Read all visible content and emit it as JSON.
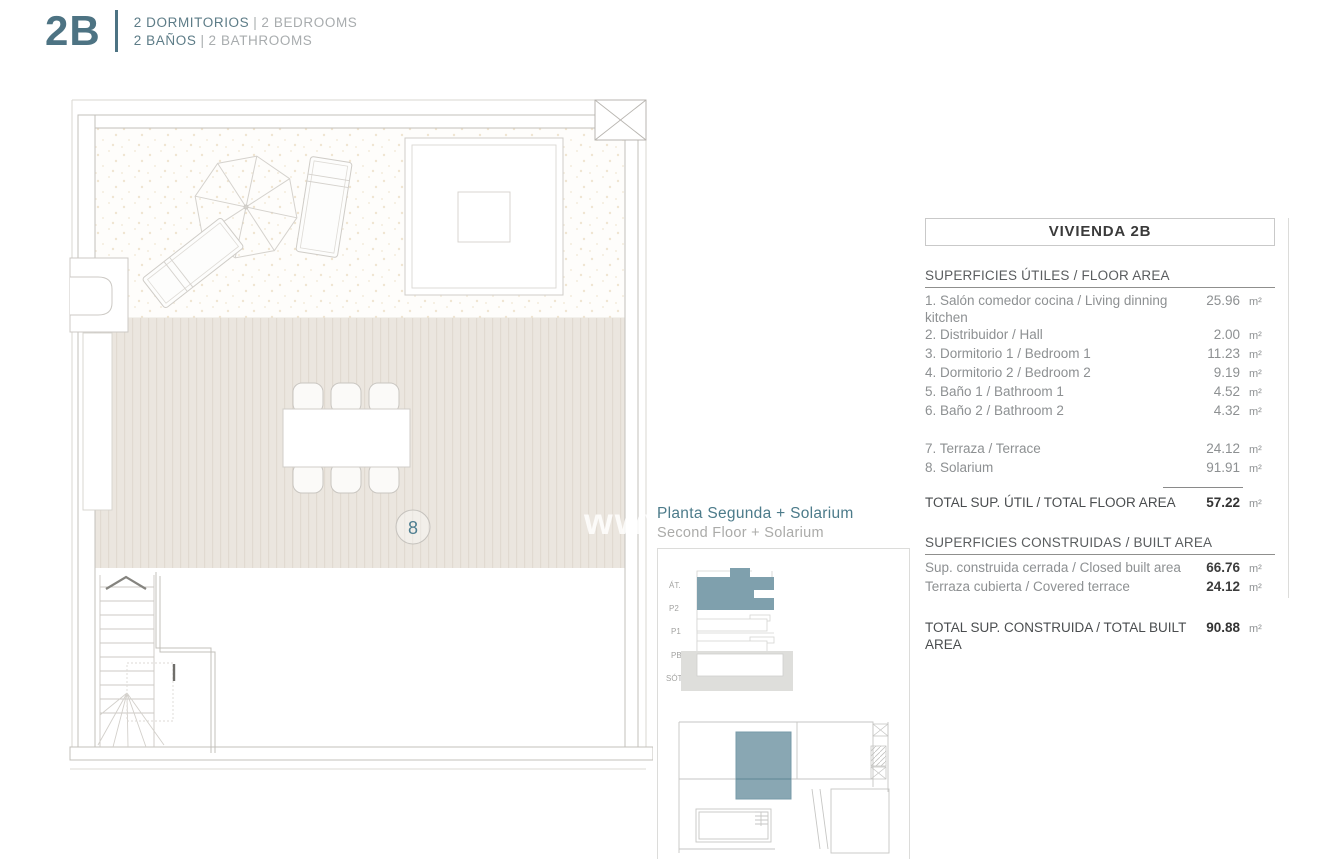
{
  "header": {
    "logo": "2B",
    "rooms_es": "2 DORMITORIOS",
    "rooms_en": "2 BEDROOMS",
    "baths_es": "2 BAÑOS",
    "baths_en": "2 BATHROOMS",
    "sep": "|"
  },
  "plan": {
    "room_label": "8",
    "watermark": "www.imm"
  },
  "location": {
    "title_es": "Planta Segunda + Solarium",
    "title_en": "Second Floor + Solarium",
    "floors": [
      "ÁT.",
      "P2",
      "P1",
      "PB",
      "SÓT."
    ]
  },
  "table": {
    "title": "VIVIENDA 2B",
    "floor_header": "SUPERFICIES ÚTILES / FLOOR AREA",
    "floor_rows": [
      {
        "label": "1. Salón comedor cocina / Living dinning kitchen",
        "value": "25.96",
        "unit": "m²"
      },
      {
        "label": "2. Distribuidor / Hall",
        "value": "2.00",
        "unit": "m²"
      },
      {
        "label": "3. Dormitorio 1 / Bedroom 1",
        "value": "11.23",
        "unit": "m²"
      },
      {
        "label": "4. Dormitorio 2 / Bedroom 2",
        "value": "9.19",
        "unit": "m²"
      },
      {
        "label": "5. Baño 1 / Bathroom 1",
        "value": "4.52",
        "unit": "m²"
      },
      {
        "label": "6. Baño 2 / Bathroom 2",
        "value": "4.32",
        "unit": "m²"
      }
    ],
    "terrace_rows": [
      {
        "label": "7. Terraza / Terrace",
        "value": "24.12",
        "unit": "m²"
      },
      {
        "label": "8. Solarium",
        "value": "91.91",
        "unit": "m²"
      }
    ],
    "total_floor": {
      "label": "TOTAL SUP. ÚTIL / TOTAL FLOOR AREA",
      "value": "57.22",
      "unit": "m²"
    },
    "built_header": "SUPERFICIES CONSTRUIDAS / BUILT AREA",
    "built_rows": [
      {
        "label": "Sup. construida cerrada / Closed built area",
        "value": "66.76",
        "unit": "m²"
      },
      {
        "label": "Terraza cubierta / Covered terrace",
        "value": "24.12",
        "unit": "m²"
      }
    ],
    "total_built": {
      "label": "TOTAL SUP. CONSTRUIDA / TOTAL BUILT AREA",
      "value": "90.88",
      "unit": "m²"
    }
  },
  "colors": {
    "accent": "#4d7383",
    "highlight": "#7fa0ad",
    "muted": "#a8acae"
  }
}
